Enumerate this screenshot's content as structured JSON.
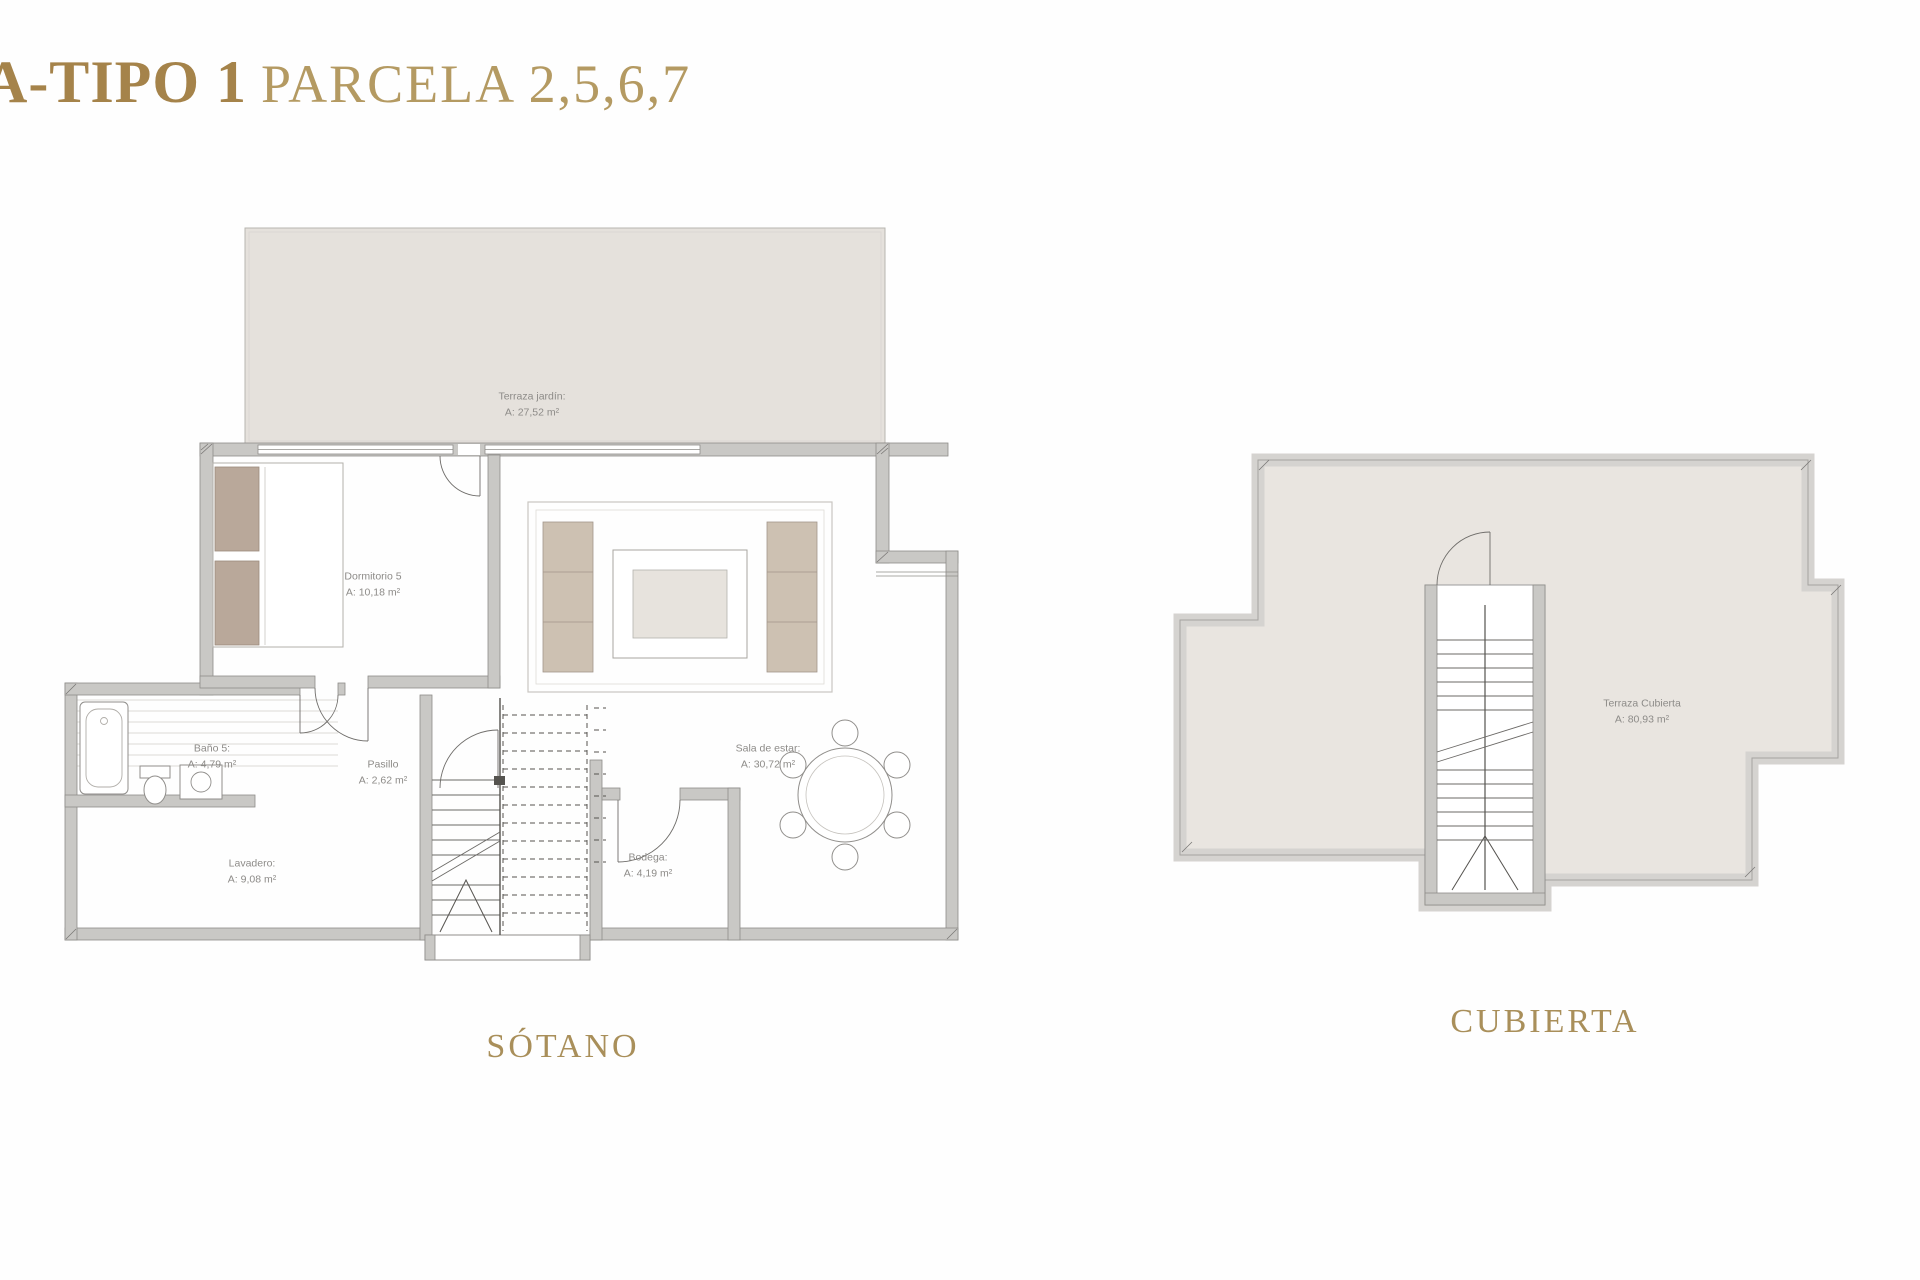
{
  "page": {
    "title_bold": "A-TIPO 1",
    "title_regular": "PARCELA 2,5,6,7"
  },
  "plans": {
    "sotano": {
      "title": "SÓTANO",
      "rooms": {
        "terraza_jardin": {
          "name": "Terraza jardín:",
          "area": "A: 27,52 m²"
        },
        "dormitorio5": {
          "name": "Dormitorio 5",
          "area": "A: 10,18 m²"
        },
        "bano5": {
          "name": "Baño 5:",
          "area": "A: 4,79 m²"
        },
        "pasillo": {
          "name": "Pasillo",
          "area": "A: 2,62 m²"
        },
        "lavadero": {
          "name": "Lavadero:",
          "area": "A: 9,08 m²"
        },
        "bodega": {
          "name": "Bodega:",
          "area": "A: 4,19 m²"
        },
        "sala_de_estar": {
          "name": "Sala de estar:",
          "area": "A: 30,72 m²"
        }
      }
    },
    "cubierta": {
      "title": "CUBIERTA",
      "rooms": {
        "terraza_cubierta": {
          "name": "Terraza Cubierta",
          "area": "A: 80,93 m²"
        }
      }
    }
  },
  "colors": {
    "accent_gold_bold": "#a5834a",
    "accent_gold": "#b49a62",
    "terrace_fill": "#e5e1dc",
    "roof_fill": "#e9e5e0",
    "wall_gray": "#c9c8c5",
    "label_gray": "#8d8b88"
  }
}
